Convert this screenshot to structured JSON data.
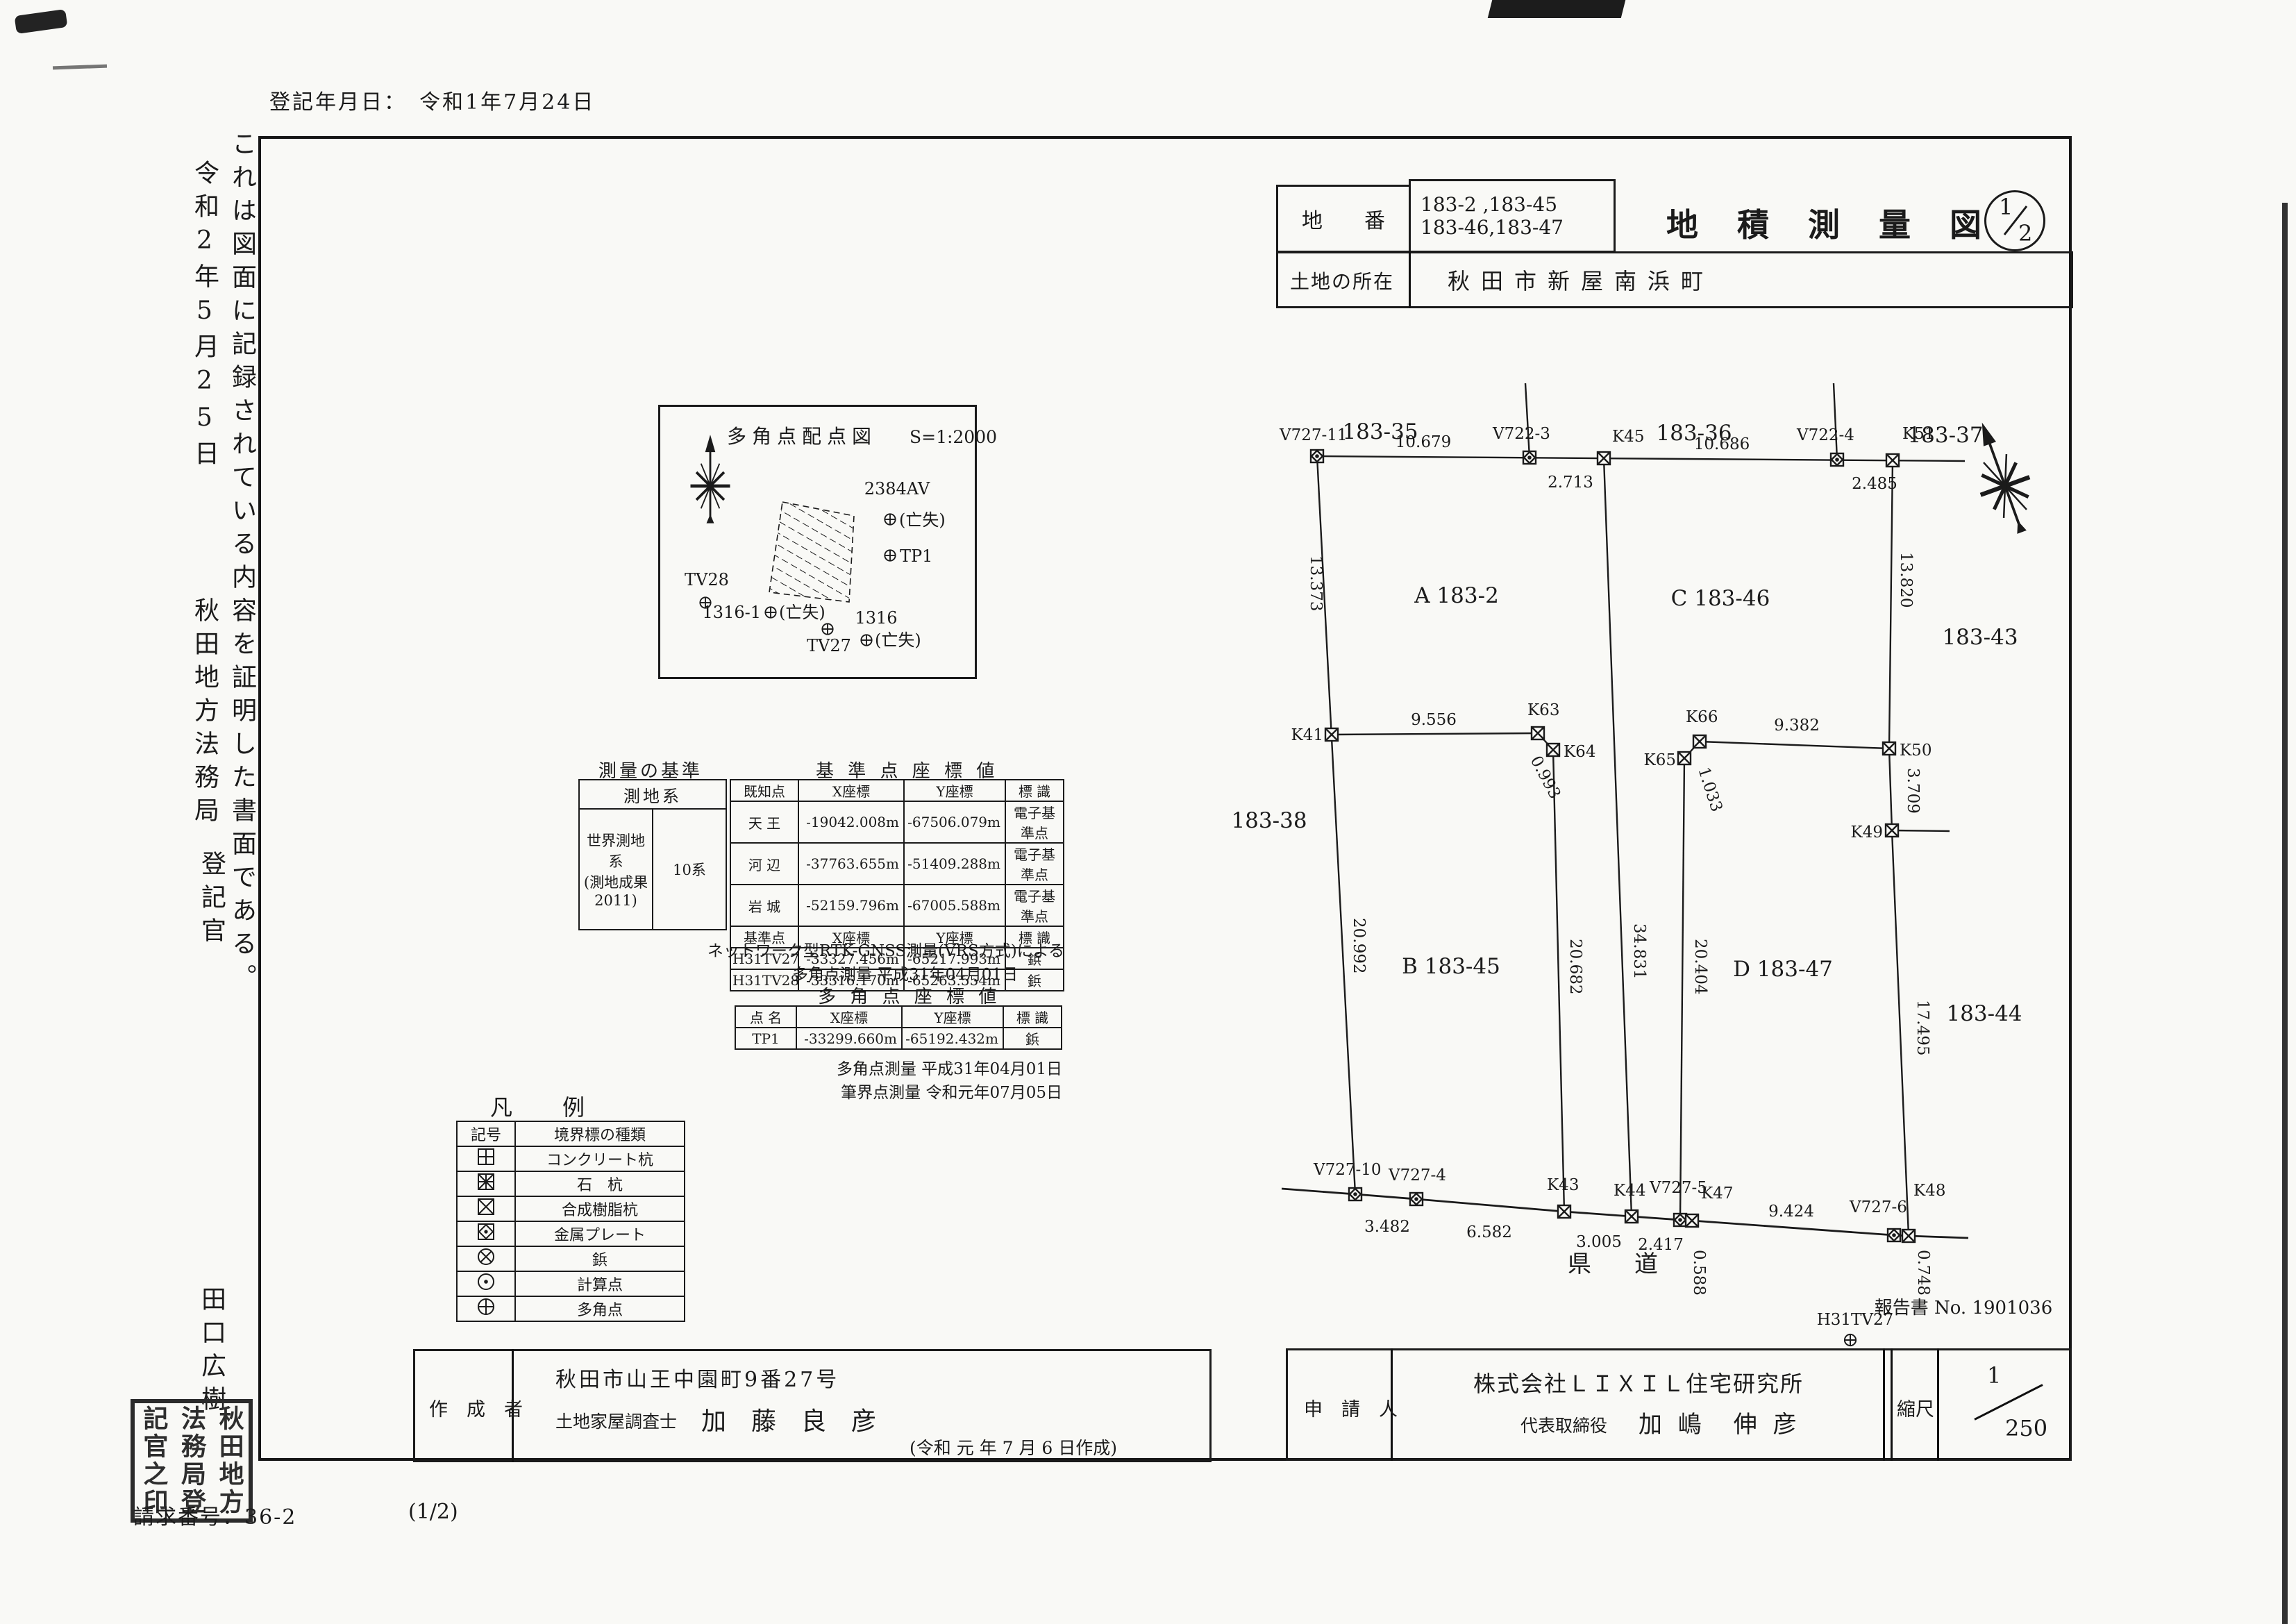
{
  "page": {
    "registration_date": "登記年月日：　令和1年7月24日",
    "request_number": "請求番号：36-2",
    "sheet_note": "(1/2)"
  },
  "certification": {
    "statement": "これは図面に記録されている内容を証明した書面である。",
    "date": "令和2年5月25日",
    "office": "秋田地方法務局",
    "registrar_title": "登記官",
    "registrar_name": "田口広樹",
    "seal_col_right": "秋田地方",
    "seal_col_mid": "法務局登",
    "seal_col_left": "記官之印"
  },
  "header": {
    "parcel_label": "地　　番",
    "parcel_line1": "183-2 ,183-45",
    "parcel_line2": "183-46,183-47",
    "location_label": "土地の所在",
    "location_value": "秋田市新屋南浜町",
    "title": "地積測量図",
    "fraction_top": "1",
    "fraction_bottom": "2"
  },
  "inset": {
    "title": "多角点配点図",
    "scale": "S=1:2000",
    "p2384av": "2384AV",
    "lost": "(亡失)",
    "tp1": "TP1",
    "tv28": "TV28",
    "p1316_1": "1316-1",
    "tv27": "TV27",
    "p1316": "1316"
  },
  "basis_table": {
    "title": "測量の基準",
    "header": "測地系",
    "system_line1": "世界測地系",
    "system_line2": "(測地成果2011)",
    "zone": "10系"
  },
  "control_table": {
    "title": "基 準 点 座 標 値",
    "headers": [
      "既知点",
      "X座標",
      "Y座標",
      "標 識"
    ],
    "rows": [
      [
        "天 王",
        "-19042.008m",
        "-67506.079m",
        "電子基準点"
      ],
      [
        "河 辺",
        "-37763.655m",
        "-51409.288m",
        "電子基準点"
      ],
      [
        "岩 城",
        "-52159.796m",
        "-67005.588m",
        "電子基準点"
      ],
      [
        "基準点",
        "X座標",
        "Y座標",
        "標 識"
      ],
      [
        "H31TV27",
        "-33327.456m",
        "-65217.993m",
        "鋲"
      ],
      [
        "H31TV28",
        "-33316.170m",
        "-65263.554m",
        "鋲"
      ]
    ],
    "note1": "ネットワーク型RTK-GNSS測量(VRS方式)による",
    "note2": "多角点測量 平成31年04月01日"
  },
  "traverse_table": {
    "title": "多 角 点 座 標 値",
    "headers": [
      "点 名",
      "X座標",
      "Y座標",
      "標 識"
    ],
    "rows": [
      [
        "TP1",
        "-33299.660m",
        "-65192.432m",
        "鋲"
      ]
    ],
    "note1": "多角点測量 平成31年04月01日",
    "note2": "筆界点測量 令和元年07月05日"
  },
  "legend": {
    "title": "凡　例",
    "col_symbol": "記号",
    "col_type": "境界標の種類",
    "rows": [
      {
        "icon": "concrete-pile-icon",
        "label": "コンクリート杭"
      },
      {
        "icon": "stone-pile-icon",
        "label": "石　杭"
      },
      {
        "icon": "resin-pile-icon",
        "label": "合成樹脂杭"
      },
      {
        "icon": "metal-plate-icon",
        "label": "金属プレート"
      },
      {
        "icon": "nail-icon",
        "label": "鋲"
      },
      {
        "icon": "calc-point-icon",
        "label": "計算点"
      },
      {
        "icon": "traverse-point-icon",
        "label": "多角点"
      }
    ]
  },
  "plot": {
    "road_label": "県　道",
    "report_label": "報告書 No. 1901036",
    "points": {
      "V727_11": "V727-11",
      "V722_3": "V722-3",
      "K45": "K45",
      "V722_4": "V722-4",
      "K51": "K51",
      "K41": "K41",
      "K63": "K63",
      "K64": "K64",
      "K66": "K66",
      "K65": "K65",
      "K50": "K50",
      "K49": "K49",
      "V727_10": "V727-10",
      "V727_4": "V727-4",
      "K43": "K43",
      "K44": "K44",
      "V727_5": "V727-5",
      "K47": "K47",
      "V727_6": "V727-6",
      "K48": "K48",
      "H31TV27": "H31TV27"
    },
    "distances": {
      "top1": "10.679",
      "top2": "2.713",
      "top3": "10.686",
      "top4": "2.485",
      "west1": "13.373",
      "west2": "20.992",
      "mid1": "9.556",
      "mid2": "0.993",
      "mid3": "34.831",
      "mid4": "9.382",
      "mid5": "1.033",
      "east1": "13.820",
      "east2": "3.709",
      "east3": "17.495",
      "col1": "20.682",
      "col2": "20.404",
      "bot1": "3.482",
      "bot2": "6.582",
      "bot3": "3.005",
      "bot4": "2.417",
      "bot5": "0.588",
      "bot6": "9.424",
      "bot7": "0.748"
    },
    "parcels": {
      "p35": "183-35",
      "p36": "183-36",
      "p37": "183-37",
      "p38": "183-38",
      "p43": "183-43",
      "p44": "183-44",
      "pa": "A 183-2",
      "pb": "B 183-45",
      "pc": "C 183-46",
      "pd": "D 183-47"
    }
  },
  "footer": {
    "creator_label": "作　成　者",
    "creator_address": "秋田市山王中園町9番27号",
    "creator_title": "土地家屋調査士",
    "creator_name": "加　藤　良　彦",
    "creator_date": "(令和 元 年 7 月 6 日作成)",
    "applicant_label": "申　請　人",
    "applicant_company": "株式会社ＬＩＸＩＬ住宅研究所",
    "applicant_role": "代表取締役",
    "applicant_name": "加 嶋　伸 彦",
    "scale_label": "縮尺",
    "scale_numerator": "1",
    "scale_denominator": "250"
  }
}
